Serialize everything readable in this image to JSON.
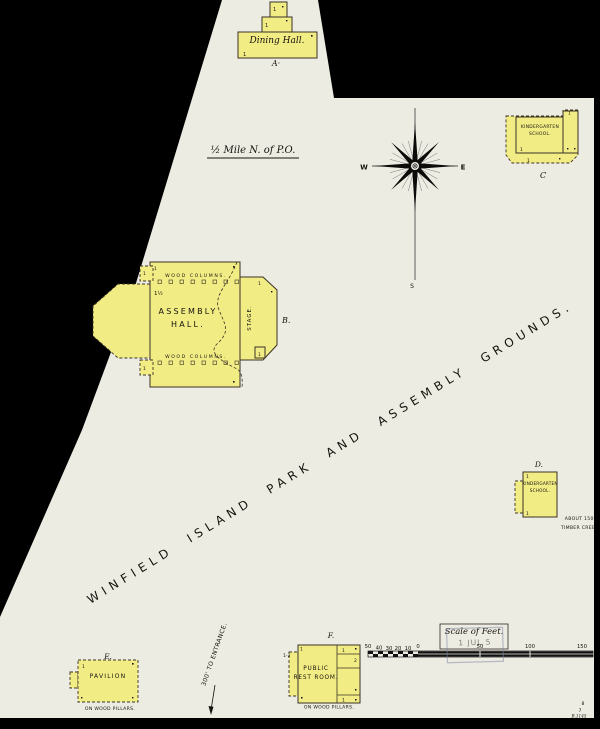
{
  "colors": {
    "background": "#000000",
    "paper": "#edece3",
    "building_fill": "#f2ec85",
    "building_outline": "#3a3226",
    "ink": "#16130e",
    "stamp": "#7d84a0"
  },
  "map": {
    "note_half_mile": "½ Mile N. of P.O.",
    "diagonal_title": "WINFIELD ISLAND PARK AND ASSEMBLY GROUNDS.",
    "entrance_note": "300' TO ENTRANCE.",
    "mark_one": "1",
    "compass": {
      "west": "W",
      "east": "E",
      "south": "S"
    },
    "buildings": {
      "dining_hall": {
        "name": "Dining Hall.",
        "label": "A·"
      },
      "assembly_hall": {
        "line1": "ASSEMBLY",
        "line2": "HALL.",
        "label": "B.",
        "stage": "STAGE.",
        "wood_columns": "WOOD COLUMNS.",
        "stories": "1½"
      },
      "kindergarten_c": {
        "line1": "KINDERGARTEN",
        "line2": "SCHOOL.",
        "label": "C"
      },
      "kindergarten_d": {
        "line1": "KINDERGARTEN",
        "line2": "SCHOOL.",
        "label": "D.",
        "note1": "ABOUT 150'",
        "note2": "TIMBER CREE"
      },
      "pavilion": {
        "name": "PAVILION",
        "label": "E.",
        "note": "ON WOOD PILLARS."
      },
      "rest_room": {
        "line1": "PUBLIC",
        "line2": "REST ROOM.",
        "label": "F.",
        "stories": "1-2",
        "room1": "1",
        "room2": "2",
        "room3": "1",
        "note": "ON WOOD PILLARS."
      }
    },
    "scale": {
      "title": "Scale of Feet.",
      "ticks": [
        "50",
        "40",
        "30",
        "20",
        "10",
        "0",
        "50",
        "100",
        "150"
      ],
      "stamp": "1 JUL 5"
    },
    "corner_marks": {
      "m1": "8",
      "m2": "7",
      "m3": "B.1145"
    }
  }
}
